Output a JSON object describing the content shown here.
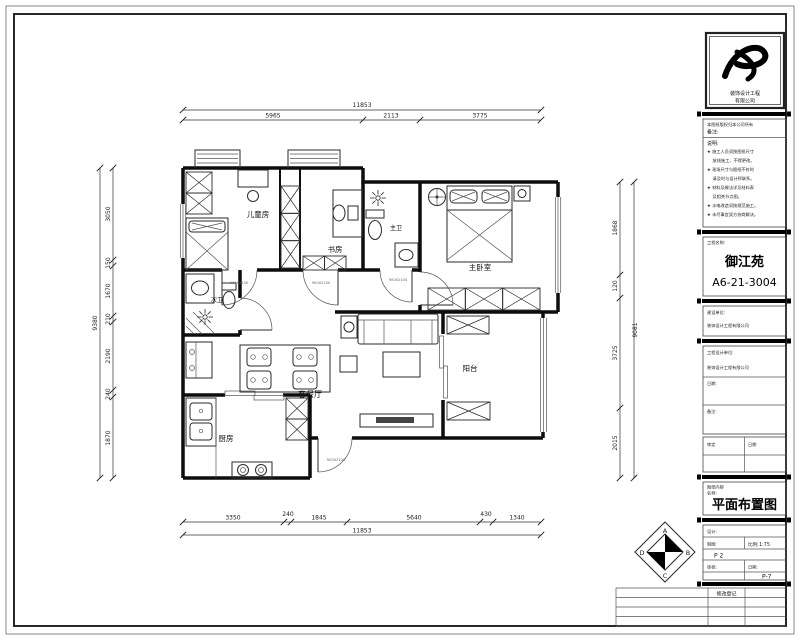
{
  "sheet": {
    "bg": "#ffffff",
    "line_color": "#1a1a1a"
  },
  "floor_plan": {
    "rooms": {
      "children_room": "儿童房",
      "study": "书房",
      "master_bath": "主卫",
      "master_bedroom": "主卧室",
      "second_bath": "次卫",
      "living_dining": "客餐厅",
      "kitchen": "厨房",
      "balcony": "阳台"
    },
    "door_tag": "900X2100",
    "dims": {
      "top": {
        "total": "11853",
        "segs": [
          "5965",
          "2113",
          "3775"
        ]
      },
      "bottom": {
        "total": "11853",
        "segs": [
          "3350",
          "240",
          "1845",
          "5640",
          "430",
          "1340"
        ]
      },
      "left": {
        "total": "9380",
        "segs": [
          "3050",
          "150",
          "1670",
          "210",
          "2190",
          "240",
          "1870"
        ]
      },
      "right": {
        "total": "9081",
        "segs": [
          "1868",
          "120",
          "3725",
          "2015"
        ]
      }
    }
  },
  "title_block": {
    "logo_line1": "装饰设计工程",
    "logo_line2": "有限公司",
    "header_note": "本图纸版权归本公司所有",
    "remark_label": "备注:",
    "notes_label": "说明:",
    "notes": [
      "★ 施工人员须按图纸尺寸",
      "　 放线施工，不得更改。",
      "★ 现场尺寸与图纸不符时",
      "　 请及时与设计师联系。",
      "★ 材料及做法详见材料表",
      "　 及相关节点图。",
      "★ 水电改造须按规范施工。",
      "★ 未尽事宜双方协商解决。"
    ],
    "project_label": "工程名称:",
    "project_name": "御江苑",
    "project_number": "A6-21-3004",
    "client_label": "建设单位:",
    "client_value": "装饰设计工程有限公司",
    "designer_label": "工程设计单位:",
    "designer_value": "装饰设计工程有限公司",
    "date_label": "日期:",
    "remark2_label": "备注:",
    "approve_label": "审定",
    "approve_date_label": "日期",
    "content_label1": "图纸内容",
    "content_label2": "名称:",
    "drawing_title": "平面布置图",
    "design_label": "设计:",
    "draft_label": "制图:",
    "scale_value": "比例 1:75",
    "mark": "P 2",
    "check_label": "审核:",
    "date2_label": "日期:",
    "sheet_no": "P-7",
    "revision_header": "修改登记",
    "compass": {
      "a": "A",
      "b": "B",
      "c": "C",
      "d": "D"
    }
  }
}
